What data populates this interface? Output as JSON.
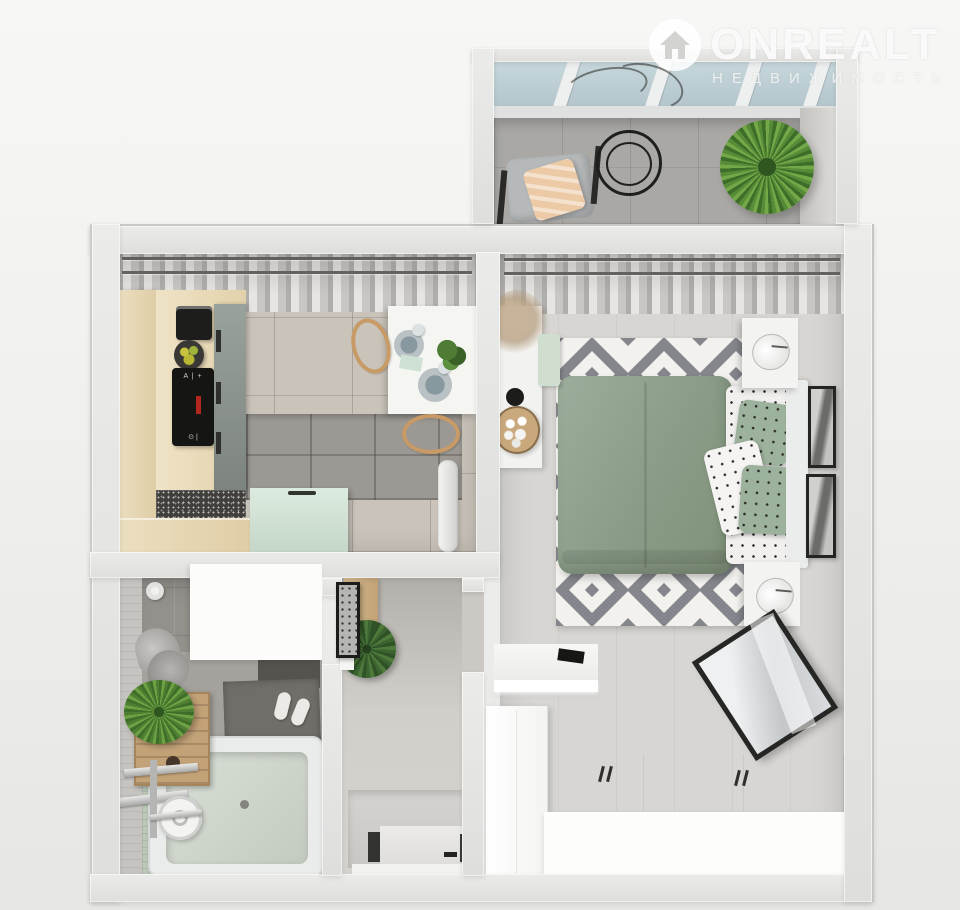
{
  "watermark": {
    "brand": "ONREALT",
    "subtitle": "НЕДВИЖИМОСТЬ",
    "icon": "house-icon"
  },
  "kitchen": {
    "cooktop_controls_top": "A | +",
    "cooktop_controls_bottom": "⊙ |"
  },
  "palette": {
    "background": "#ededeb",
    "wall": "#e6e6e4",
    "sage_green": "#8a9c87",
    "mint": "#d2e2d6",
    "wood_cabinet": "#e6d6b1",
    "rug_gray": "#84868c",
    "rug_white": "#f2f1ee",
    "glass_blue": "#bccfd5",
    "balcony_floor": "#a9a8a5",
    "kitchen_floor": "#c9c3b9",
    "bedroom_floor": "#d8d6d2",
    "bath_mosaic": "#bcc8b8",
    "blanket_peach": "#eccaa6"
  },
  "rooms": {
    "balcony": {
      "items": [
        "glazed-window-band",
        "lounge-chair",
        "peach-blanket",
        "wire-coffee-table",
        "palm-plant",
        "tiled-floor"
      ]
    },
    "kitchen": {
      "items": [
        "sheer-curtains",
        "double-curtain-rod",
        "wood-cabinet-column",
        "coffee-machine",
        "fruit-bowl",
        "induction-cooktop",
        "tall-gray-cabinet",
        "stone-countertop",
        "wood-base-cabinet",
        "mint-cabinet",
        "gray-wall-tiles",
        "dining-table",
        "place-setting",
        "place-setting",
        "table-plant",
        "bentwood-chair",
        "bentwood-chair",
        "towel-radiator"
      ]
    },
    "bedroom": {
      "items": [
        "sheer-curtains",
        "diamond-pattern-rug",
        "double-bed-sage-duvet",
        "polka-dot-pillows",
        "headboard",
        "nightstand-with-lamp",
        "nightstand-with-lamp",
        "framed-picture",
        "framed-picture",
        "side-console",
        "pampas-grass",
        "mint-bench",
        "serving-tray",
        "wall-tv",
        "desk",
        "laptop",
        "tall-wardrobe",
        "leaning-mirror",
        "low-wardrobe-with-handles"
      ]
    },
    "bathroom": {
      "items": [
        "bathtub",
        "shower-fixture",
        "chrome-faucet",
        "bath-mat",
        "slippers",
        "wooden-crate-shelf",
        "fern-plant",
        "hanging-towel",
        "toilet-paper-roll",
        "dark-vanity",
        "mint-mosaic-floor",
        "white-utility-block"
      ]
    },
    "hallway": {
      "items": [
        "console-table",
        "framed-print",
        "monstera-plant",
        "open-bathroom-door",
        "bedroom-doorway",
        "entrance-door",
        "door-handle"
      ]
    }
  }
}
